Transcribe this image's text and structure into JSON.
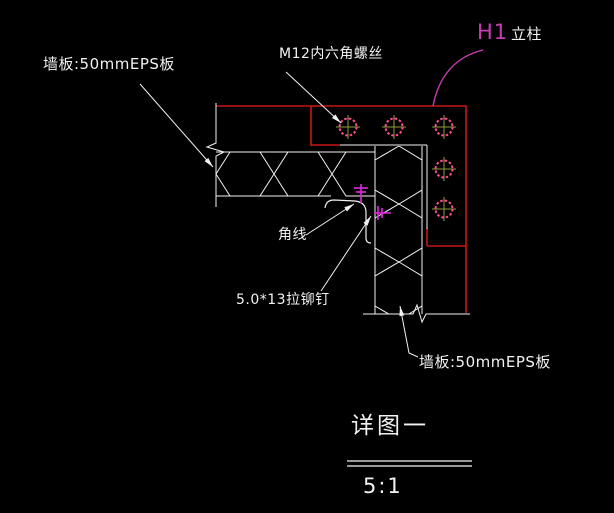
{
  "drawing": {
    "labels": {
      "wall_panel_top": "墙板:50mmEPS板",
      "bolt": "M12内六角螺丝",
      "column_tag": "H1",
      "column_name": "立柱",
      "corner_trim": "角线",
      "rivet": "5.0*13拉铆钉",
      "wall_panel_bottom": "墙板:50mmEPS板"
    },
    "title": "详图一",
    "scale": "5:1",
    "colors": {
      "background": "#000000",
      "line": "#f2f2f2",
      "steel_red": "#c81616",
      "tag_magenta": "#c83cb4",
      "bolt_pink": "#ff4d94",
      "bolt_cross_olive": "#8f9a3c",
      "rivet_magenta": "#e028e0"
    }
  }
}
